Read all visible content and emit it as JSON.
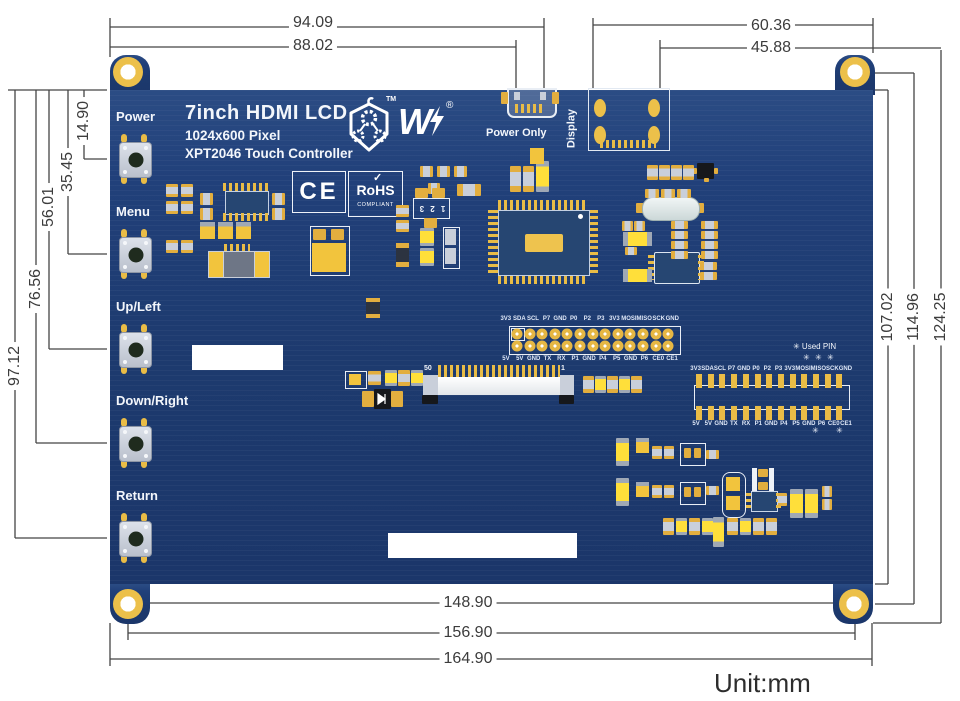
{
  "unit_note": "Unit:mm",
  "dimensions": {
    "top": [
      "94.09",
      "88.02",
      "60.36",
      "45.88"
    ],
    "left": [
      "14.90",
      "35.45",
      "56.01",
      "76.56",
      "97.12"
    ],
    "right": [
      "107.02",
      "114.96",
      "124.25"
    ],
    "bottom": [
      "148.90",
      "156.90",
      "164.90"
    ]
  },
  "board": {
    "title": "7inch HDMI LCD",
    "subtitle_resolution": "1024x600 Pixel",
    "subtitle_touch": "XPT2046 Touch Controller",
    "logo": {
      "wordmark": "W",
      "tm": "TM",
      "registered": "®"
    },
    "certifications": {
      "ce": "CE",
      "check": "✓",
      "rohs": "RoHS",
      "rohs_sub": "COMPLIANT"
    },
    "buttons": [
      "Power",
      "Menu",
      "Up/Left",
      "Down/Right",
      "Return"
    ],
    "connectors": {
      "power": "Power Only",
      "display": "Display"
    },
    "gpio_top_labels": [
      "3V3",
      "SDA",
      "SCL",
      "P7",
      "GND",
      "P0",
      "P2",
      "P3",
      "3V3",
      "MOSI",
      "MISO",
      "SCK",
      "GND"
    ],
    "gpio_bottom_labels": [
      "5V",
      "5V",
      "GND",
      "TX",
      "RX",
      "P1",
      "GND",
      "P4",
      "P5",
      "GND",
      "P6",
      "CE0",
      "CE1"
    ],
    "used_pin_note": "✳ Used PIN",
    "asterisk": "✳",
    "ffc": {
      "pin50": "50",
      "pin1": "1"
    },
    "ic_marking": "1 2 3"
  },
  "colors": {
    "board_navy": "#1d3a6e",
    "pad_gold": "#e9bc46",
    "component_yellow": "#ffdf3a",
    "silkscreen": "#f3f6fb",
    "dimension_line": "#454545"
  }
}
